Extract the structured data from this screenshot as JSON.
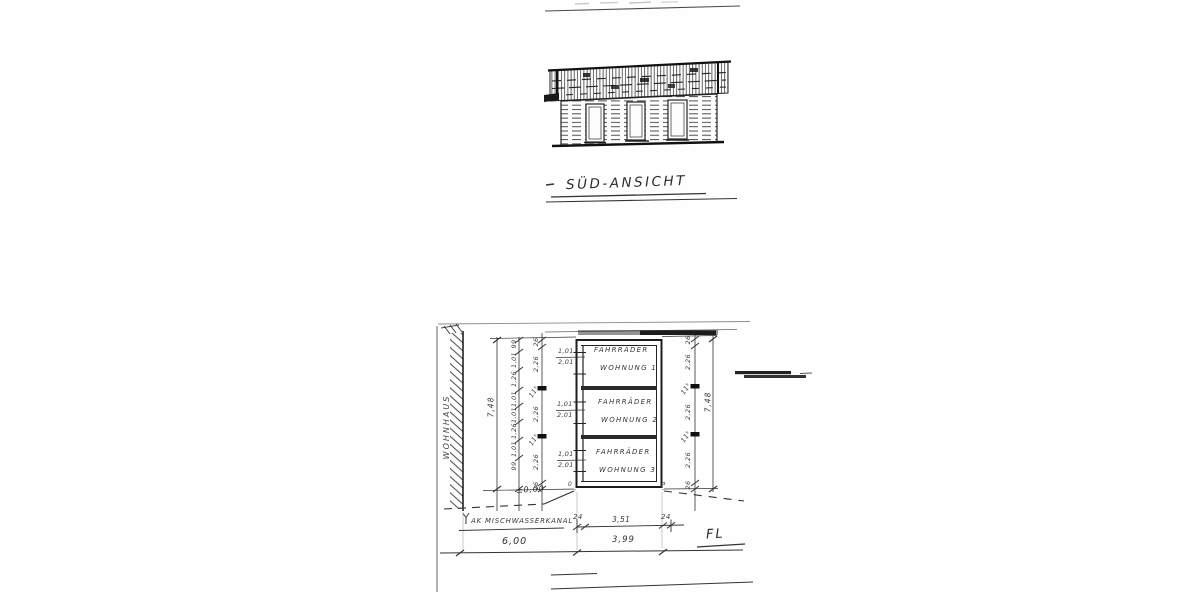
{
  "elevation": {
    "title": "SÜD-ANSICHT"
  },
  "plan": {
    "wohnhaus_label": "WOHNHAUS",
    "rooms": [
      {
        "line1": "FAHRRÄDER",
        "line2": "WOHNUNG 1",
        "door_w": "1,01",
        "door_h": "2,01"
      },
      {
        "line1": "FAHRRÄDER",
        "line2": "WOHNUNG 2",
        "door_w": "1,01",
        "door_h": "2,01"
      },
      {
        "line1": "FAHRRÄDER",
        "line2": "WOHNUNG 3",
        "door_w": "1,01",
        "door_h": "2,01"
      }
    ],
    "level_label": "±0,00",
    "corner_left": "0",
    "corner_right": "P",
    "sewer_label": "AK MISCHWASSERKANAL",
    "fl_label": "FL",
    "dims": {
      "left_inner_chain": [
        "99",
        "1,01",
        "1,26",
        "1,01",
        "1,01",
        "1,26",
        "1,01",
        "99"
      ],
      "left_outer_chain": [
        "26",
        "2,26",
        "11⁵",
        "2,26",
        "11⁵",
        "2,26",
        "26"
      ],
      "right_chain": [
        "26",
        "2,26",
        "11⁵",
        "2,26",
        "11⁵",
        "2,26",
        "26"
      ],
      "left_total": "7,48",
      "right_total": "7,48",
      "bottom_small": [
        "24",
        "3,51",
        "24"
      ],
      "bottom_left_span": "6,00",
      "bottom_right_span": "3,99"
    }
  }
}
